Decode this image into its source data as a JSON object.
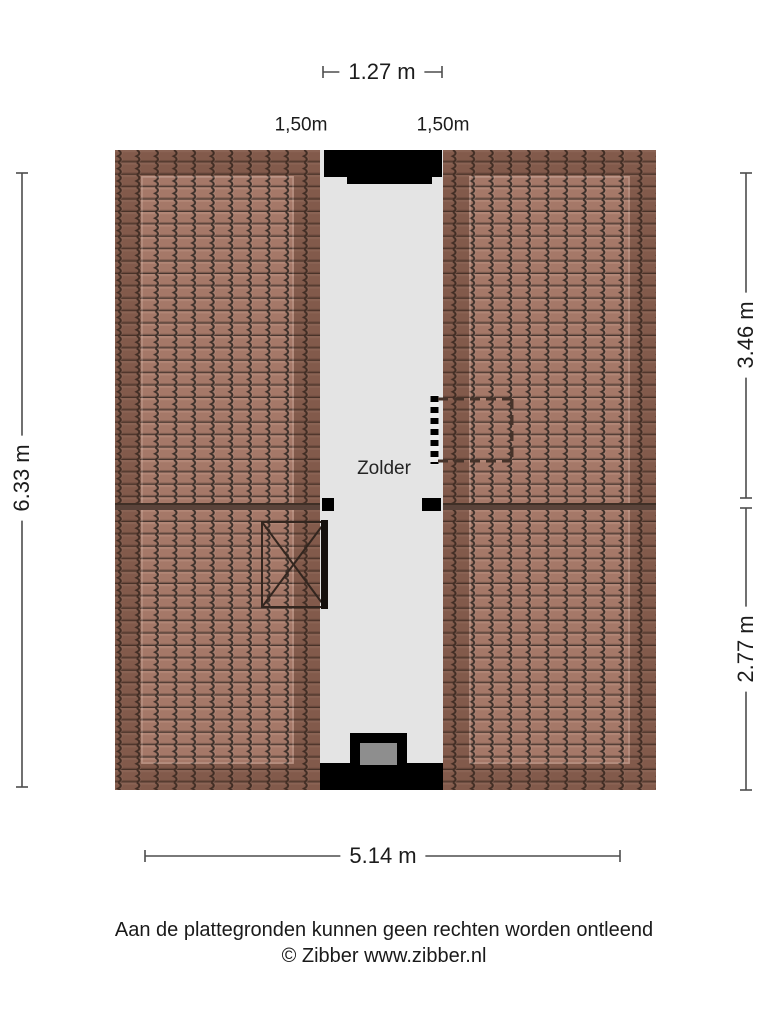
{
  "room": {
    "label": "Zolder"
  },
  "dimensions": {
    "top_width": "1.27 m",
    "headroom_left": "1,50m",
    "headroom_right": "1,50m",
    "side_height": "6.33 m",
    "right_upper": "3.46 m",
    "right_lower": "2.77 m",
    "bottom_width": "5.14 m"
  },
  "footer": {
    "disclaimer": "Aan de plattegronden kunnen geen rechten worden ontleend",
    "copyright": "© Zibber www.zibber.nl"
  },
  "colors": {
    "roof_tile": "#a57868",
    "roof_seam": "#3c2f29",
    "corridor": "#e4e4e4",
    "wall": "#000000",
    "dimension_line": "#4d4d4d",
    "text": "#1c1c1c"
  }
}
